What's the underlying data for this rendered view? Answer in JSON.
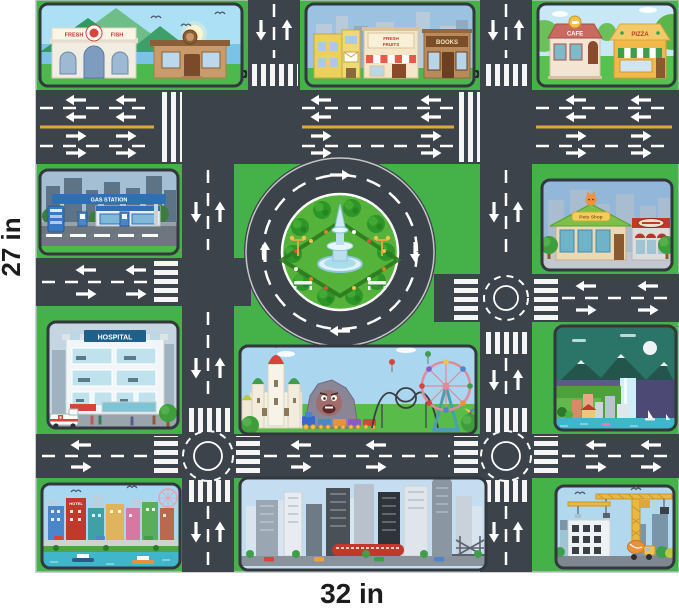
{
  "product": {
    "width_label": "32 in",
    "height_label": "27 in"
  },
  "scenes": {
    "seaside": {
      "depicts": "seaside shop scene with mountains, sun and gulls",
      "sign_word1": "FRESH",
      "sign_word2": "FISH"
    },
    "shops": {
      "depicts": "row of downtown shops",
      "fruits_line1": "FRESH",
      "fruits_line2": "FRUITS",
      "books": "BOOKS"
    },
    "cafe_pizza": {
      "depicts": "cafe and pizzeria on a green lawn",
      "cafe": "CAFE",
      "pizza": "PIZZA"
    },
    "gas_station": {
      "depicts": "blue gas station with pumps",
      "sign": "GAS STATION"
    },
    "pets": {
      "depicts": "pet shop with cat on roof and market next door",
      "sign": "Pets Shop"
    },
    "hospital": {
      "depicts": "hospital cutaway building with ambulance",
      "sign": "HOSPITAL"
    },
    "waterfall": {
      "depicts": "night mountain landscape with waterfall, town and sailboats"
    },
    "amusement": {
      "depicts": "amusement park with castle, dark ride, train, roller coaster and ferris wheel"
    },
    "city": {
      "depicts": "waterfront city with boats",
      "hotel": "HOTEL"
    },
    "skyline": {
      "depicts": "downtown skyline with red stadium and truss bridge"
    },
    "construction": {
      "depicts": "construction site with tower cranes and mixer truck"
    }
  },
  "colors": {
    "road": "#3d434a",
    "lane_marking": "#ffffff",
    "center_line": "#e2a63e",
    "grass": "#44b149",
    "roundabout_green": "#55b23a",
    "water": "#3fb6c9",
    "tile_border": "#33383e"
  }
}
